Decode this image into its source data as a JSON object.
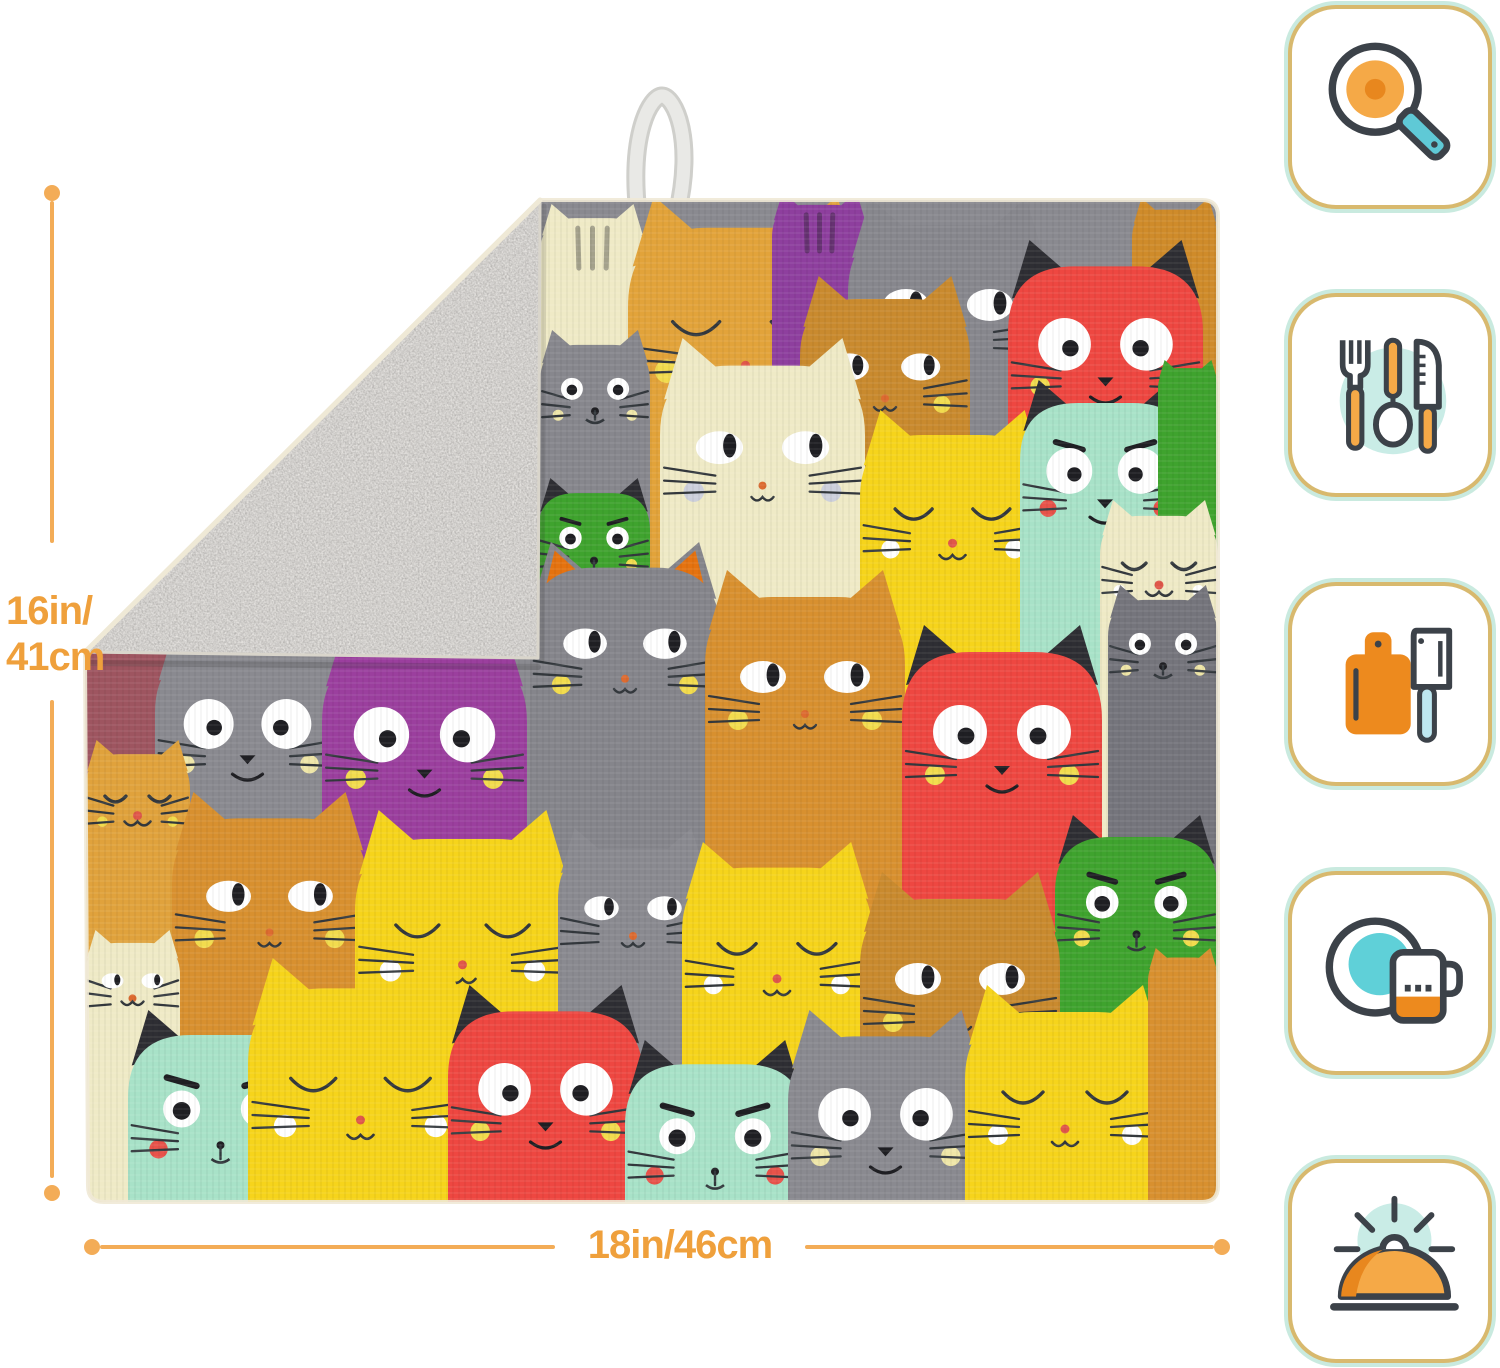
{
  "product_photo": {
    "hanging_loop_color": "#E7E7E4",
    "backing_color": "#C9C6BF",
    "pattern_background": "#8A8A90",
    "edge_binding_color": "#EFE9D6",
    "cats": [
      {
        "x": 480,
        "y": 124,
        "w": 105,
        "color": "#EFEAC6",
        "stripes": true
      },
      {
        "x": 568,
        "y": 116,
        "w": 235,
        "color": "#E2A33A",
        "face": "closed",
        "tongue": true,
        "cheeks": "yellow"
      },
      {
        "x": 712,
        "y": 112,
        "w": 95,
        "color": "#8E3F9E",
        "stripes": true
      },
      {
        "x": 788,
        "y": 118,
        "w": 200,
        "color": "#87878D",
        "face": "side"
      },
      {
        "x": 1072,
        "y": 118,
        "w": 86,
        "color": "#CF8B2A"
      },
      {
        "x": 948,
        "y": 160,
        "w": 195,
        "color": "#EE4741",
        "face": "wide",
        "ear": "black",
        "cheeks": "yellow"
      },
      {
        "x": 740,
        "y": 196,
        "w": 170,
        "color": "#C98A2E",
        "face": "side",
        "cheeks": "yellow"
      },
      {
        "x": 600,
        "y": 258,
        "w": 205,
        "color": "#EFEAC6",
        "face": "side",
        "cheeks": "gray"
      },
      {
        "x": 480,
        "y": 250,
        "w": 110,
        "color": "#87878D",
        "face": "round",
        "cheeks": "cream"
      },
      {
        "x": 800,
        "y": 330,
        "w": 185,
        "color": "#F6D41B",
        "face": "closed",
        "cheeks": "white"
      },
      {
        "x": 960,
        "y": 300,
        "w": 170,
        "color": "#A8E2C8",
        "face": "wide",
        "ear": "black",
        "brows": true,
        "cheeks": "red"
      },
      {
        "x": 1098,
        "y": 280,
        "w": 60,
        "color": "#3FA32E"
      },
      {
        "x": 1040,
        "y": 420,
        "w": 118,
        "color": "#EFEAC6",
        "face": "closed",
        "cheeks": "white"
      },
      {
        "x": 478,
        "y": 398,
        "w": 112,
        "color": "#3FA32E",
        "face": "round",
        "ear": "black",
        "brows": true,
        "cheeks": "yellow"
      },
      {
        "x": 25,
        "y": 520,
        "w": 95,
        "color": "#9E5560"
      },
      {
        "x": 95,
        "y": 545,
        "w": 185,
        "color": "#8A8A90",
        "face": "wide",
        "cheeks": "cream"
      },
      {
        "x": 262,
        "y": 545,
        "w": 205,
        "color": "#9B3F9E",
        "face": "wide",
        "cheeks": "yellow"
      },
      {
        "x": 470,
        "y": 462,
        "w": 190,
        "color": "#85858B",
        "face": "side",
        "ear": "orange",
        "cheeks": "yellow"
      },
      {
        "x": 645,
        "y": 490,
        "w": 200,
        "color": "#D8902F",
        "face": "side",
        "cheeks": "yellow"
      },
      {
        "x": 842,
        "y": 545,
        "w": 200,
        "color": "#EE4741",
        "face": "wide",
        "ear": "black",
        "cheeks": "yellow"
      },
      {
        "x": 1048,
        "y": 505,
        "w": 110,
        "color": "#75757C",
        "face": "round",
        "cheeks": "cream"
      },
      {
        "x": 25,
        "y": 660,
        "w": 105,
        "color": "#E0A23C",
        "face": "closed",
        "cheeks": "yellow"
      },
      {
        "x": 112,
        "y": 712,
        "w": 195,
        "color": "#D8902F",
        "face": "side",
        "cheeks": "yellow"
      },
      {
        "x": 295,
        "y": 730,
        "w": 215,
        "color": "#F6D41B",
        "face": "closed",
        "cheeks": "white"
      },
      {
        "x": 498,
        "y": 748,
        "w": 150,
        "color": "#8A8A90",
        "face": "side"
      },
      {
        "x": 622,
        "y": 762,
        "w": 190,
        "color": "#F6D41B",
        "face": "closed",
        "cheeks": "white"
      },
      {
        "x": 995,
        "y": 735,
        "w": 163,
        "color": "#3FA32E",
        "face": "round",
        "ear": "black",
        "brows": true,
        "cheeks": "yellow"
      },
      {
        "x": 800,
        "y": 792,
        "w": 200,
        "color": "#C98A2E",
        "face": "side",
        "cheeks": "yellow"
      },
      {
        "x": 25,
        "y": 850,
        "w": 95,
        "color": "#EFEAC6",
        "face": "side"
      },
      {
        "x": 68,
        "y": 930,
        "w": 185,
        "color": "#A8E2C8",
        "face": "round",
        "ear": "black",
        "brows": true,
        "cheeks": "red"
      },
      {
        "x": 188,
        "y": 878,
        "w": 225,
        "color": "#F6D41B",
        "face": "closed",
        "cheeks": "white"
      },
      {
        "x": 388,
        "y": 905,
        "w": 195,
        "color": "#EE4741",
        "face": "wide",
        "ear": "black",
        "cheeks": "yellow"
      },
      {
        "x": 565,
        "y": 960,
        "w": 180,
        "color": "#A8E2C8",
        "face": "round",
        "ear": "black",
        "brows": true,
        "cheeks": "red"
      },
      {
        "x": 728,
        "y": 930,
        "w": 195,
        "color": "#8A8A90",
        "face": "wide",
        "cheeks": "cream"
      },
      {
        "x": 905,
        "y": 905,
        "w": 200,
        "color": "#F6D41B",
        "face": "closed",
        "cheeks": "white"
      },
      {
        "x": 1088,
        "y": 868,
        "w": 70,
        "color": "#D8902F"
      }
    ]
  },
  "dimensions": {
    "accent_color": "#F3AC57",
    "text_color": "#EFA03C",
    "height_label_lines": [
      "16in/",
      "41cm"
    ],
    "width_label": "18in/46cm"
  },
  "feature_badges": {
    "outer_border_color": "#C9EADF",
    "inner_border_color": "#D8B96E",
    "icon_outline_color": "#3C4249",
    "icon_orange": "#F5A947",
    "icon_deep_orange": "#ED8A1E",
    "icon_teal": "#5FC9D6",
    "icon_light_teal": "#C9ECE6",
    "items": [
      {
        "icon": "frying-pan-icon"
      },
      {
        "icon": "utensils-icon"
      },
      {
        "icon": "cutting-board-icon"
      },
      {
        "icon": "plate-and-mug-icon"
      },
      {
        "icon": "serving-dome-icon"
      }
    ]
  }
}
